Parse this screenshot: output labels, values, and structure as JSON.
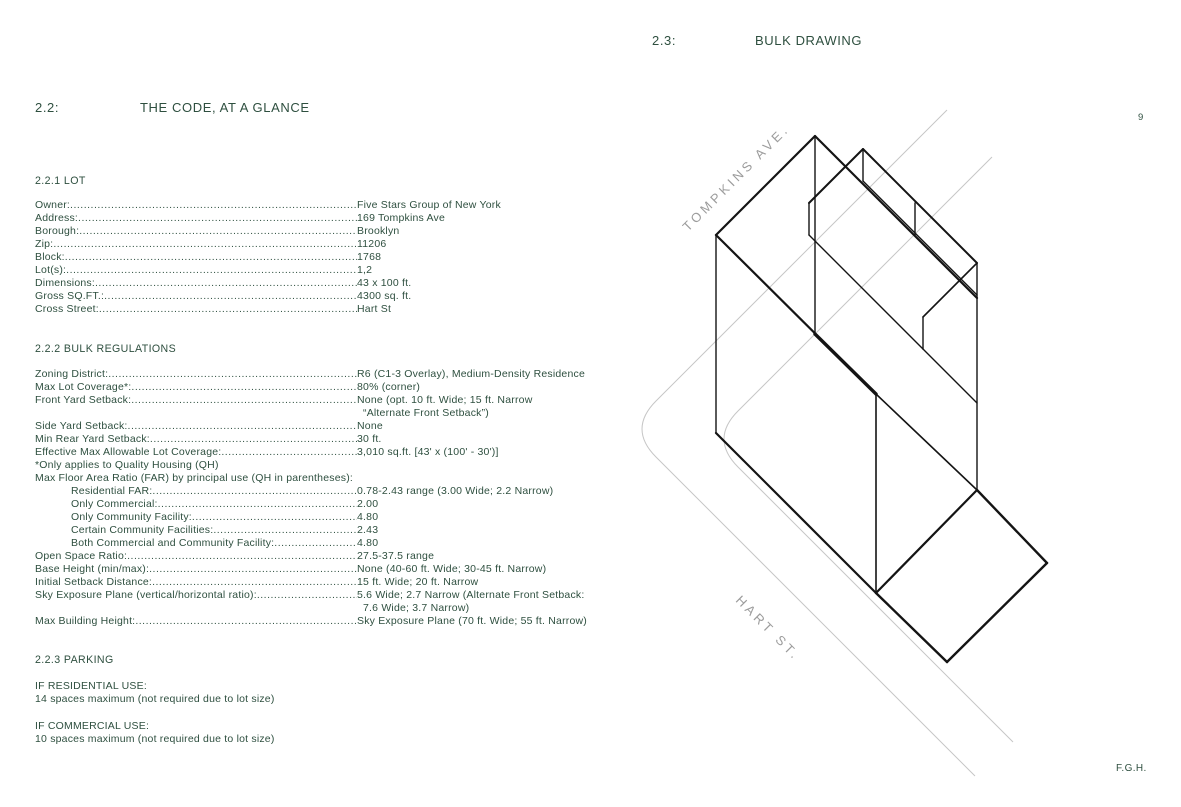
{
  "page": {
    "number": "9",
    "footer_initials": "F.G.H."
  },
  "left": {
    "section_id": "2.2:",
    "section_title": "THE CODE, AT A GLANCE",
    "lot": {
      "heading": "2.2.1 LOT",
      "rows": [
        {
          "label": "Owner:",
          "value": "Five Stars Group of New York"
        },
        {
          "label": "Address:",
          "value": "169 Tompkins Ave"
        },
        {
          "label": "Borough:",
          "value": "Brooklyn"
        },
        {
          "label": "Zip:",
          "value": "11206"
        },
        {
          "label": "Block:",
          "value": "1768"
        },
        {
          "label": "Lot(s):",
          "value": "1,2"
        },
        {
          "label": "Dimensions:",
          "value": "43 x 100 ft."
        },
        {
          "label": "Gross SQ.FT.:",
          "value": "4300 sq. ft."
        },
        {
          "label": "Cross Street:",
          "value": "Hart St"
        }
      ]
    },
    "bulk": {
      "heading": "2.2.2 BULK REGULATIONS",
      "rows": [
        {
          "label": "Zoning District:",
          "value": "R6 (C1-3 Overlay), Medium-Density Residence"
        },
        {
          "label": "Max Lot Coverage*:",
          "value": "80% (corner)"
        },
        {
          "label": "Front Yard Setback:",
          "value": "None (opt. 10 ft. Wide; 15 ft. Narrow"
        },
        {
          "type": "cont",
          "value": "“Alternate Front Setback”)"
        },
        {
          "label": "Side Yard Setback:",
          "value": "None"
        },
        {
          "label": "Min Rear Yard Setback:",
          "value": "30 ft."
        },
        {
          "label": "Effective Max Allowable Lot Coverage:",
          "value": "3,010 sq.ft. [43' x (100' - 30')]"
        },
        {
          "type": "plain",
          "label": "*Only applies to Quality Housing (QH)"
        },
        {
          "type": "plain",
          "label": "Max Floor Area Ratio (FAR) by principal use (QH in parentheses):"
        },
        {
          "indent": true,
          "label": "Residential FAR:",
          "value": "0.78-2.43 range (3.00 Wide; 2.2 Narrow)"
        },
        {
          "indent": true,
          "label": "Only Commercial:",
          "value": "2.00"
        },
        {
          "indent": true,
          "label": "Only Community Facility:",
          "value": "4.80"
        },
        {
          "indent": true,
          "label": "Certain Community Facilities:",
          "value": "2.43"
        },
        {
          "indent": true,
          "label": "Both Commercial and Community Facility:",
          "value": "4.80"
        },
        {
          "label": "Open Space Ratio:",
          "value": "27.5-37.5 range"
        },
        {
          "label": "Base Height (min/max):",
          "value": "None (40-60 ft. Wide; 30-45 ft. Narrow)"
        },
        {
          "label": "Initial Setback Distance:",
          "value": "15 ft. Wide; 20 ft. Narrow"
        },
        {
          "label": "Sky Exposure Plane (vertical/horizontal ratio):",
          "value": "5.6 Wide; 2.7 Narrow (Alternate Front Setback:"
        },
        {
          "type": "cont",
          "value": "7.6 Wide; 3.7 Narrow)"
        },
        {
          "label": "Max Building Height:",
          "value": "Sky Exposure Plane (70 ft. Wide; 55 ft. Narrow)"
        }
      ]
    },
    "parking": {
      "heading": "2.2.3 PARKING",
      "groups": [
        {
          "title": "IF RESIDENTIAL USE:",
          "detail": "14 spaces maximum (not required due to lot size)"
        },
        {
          "title": "IF COMMERCIAL USE:",
          "detail": "10 spaces maximum (not required due to lot size)"
        }
      ]
    }
  },
  "right": {
    "section_id": "2.3:",
    "section_title": "BULK DRAWING",
    "street_labels": {
      "tompkins": "TOMPKINS AVE.",
      "hart": "HART ST."
    }
  },
  "colors": {
    "text_green": "#2e4f3f",
    "street_label_gray": "#9c9c9c",
    "street_line_gray": "#c6c6c6",
    "drawing_line": "#141414"
  }
}
